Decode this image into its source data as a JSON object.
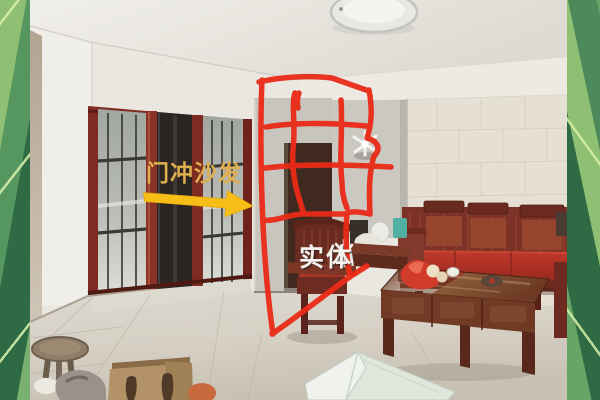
{
  "photo_annotations": {
    "door_clash_label": "门冲沙发",
    "entity_label": "实体"
  },
  "colors": {
    "annotation_red": "#ea2b17",
    "arrow_yellow": "#f6be17",
    "door_label_gold": "#dfae4e",
    "entity_label_white": "#f4f2ee",
    "border_greens": [
      "#8fbf72",
      "#55975f",
      "#2e6b45",
      "#79b070"
    ]
  }
}
